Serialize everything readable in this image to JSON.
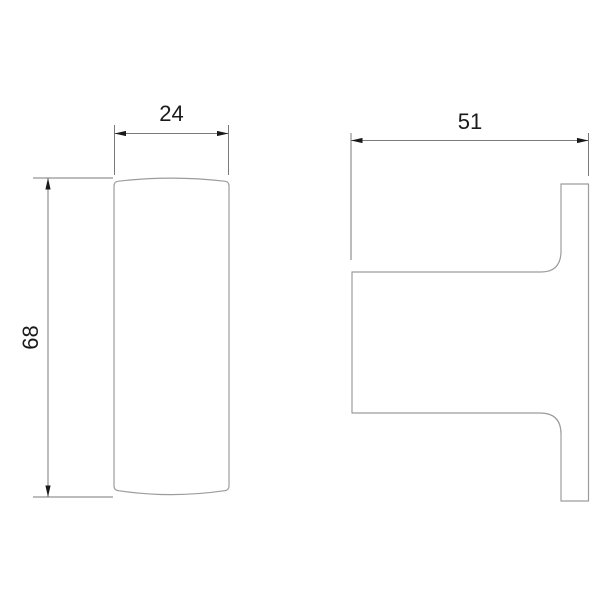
{
  "drawing": {
    "description": "Two-view orthographic dimension drawing of a wall hook",
    "background": "#ffffff",
    "outline_color": "#9c9c9c",
    "dimension_line_color": "#7a7a7a",
    "text_color": "#1a1a1a",
    "views": {
      "front": {
        "id": "front-view"
      },
      "side": {
        "id": "side-view"
      }
    },
    "dimensions": {
      "front_width": {
        "value": "24",
        "orientation": "horizontal",
        "view": "front-view"
      },
      "front_height": {
        "value": "68",
        "orientation": "vertical",
        "view": "front-view"
      },
      "side_depth": {
        "value": "51",
        "orientation": "horizontal",
        "view": "side-view"
      }
    }
  }
}
